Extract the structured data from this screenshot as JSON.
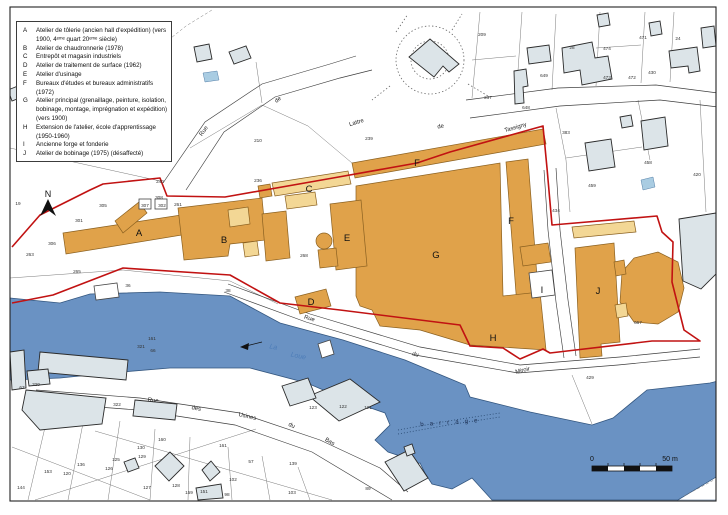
{
  "legend": {
    "items": [
      {
        "letter": "A",
        "text": "Atelier de tôlerie (ancien hall d'expédition) (vers 1900, 4ᵉᵐᵉ quart 20ᵉᵐᵉ siècle)"
      },
      {
        "letter": "B",
        "text": "Atelier de chaudronnerie (1978)"
      },
      {
        "letter": "C",
        "text": "Entrepôt et magasin industriels"
      },
      {
        "letter": "D",
        "text": "Atelier de traitement de surface (1962)"
      },
      {
        "letter": "E",
        "text": "Atelier d'usinage"
      },
      {
        "letter": "F",
        "text": "Bureaux d'études et bureaux administratifs (1972)"
      },
      {
        "letter": "G",
        "text": "Atelier principal (grenaillage, peinture, isolation, bobinage, montage, imprégnation et expédition) (vers 1900)"
      },
      {
        "letter": "H",
        "text": "Extension de l'atelier, école d'apprentissage (1950-1960)"
      },
      {
        "letter": "I",
        "text": "Ancienne forge et fonderie"
      },
      {
        "letter": "J",
        "text": "Atelier de bobinage (1975) (désaffecté)"
      }
    ]
  },
  "map": {
    "north_label": "N",
    "scale_bar": {
      "start": "0",
      "end": "50 m"
    },
    "building_labels": [
      {
        "t": "A",
        "x": 139,
        "y": 236
      },
      {
        "t": "B",
        "x": 224,
        "y": 243
      },
      {
        "t": "C",
        "x": 309,
        "y": 192
      },
      {
        "t": "D",
        "x": 311,
        "y": 305
      },
      {
        "t": "E",
        "x": 347,
        "y": 241
      },
      {
        "t": "F",
        "x": 417,
        "y": 166
      },
      {
        "t": "F",
        "x": 511,
        "y": 224
      },
      {
        "t": "G",
        "x": 436,
        "y": 258
      },
      {
        "t": "H",
        "x": 493,
        "y": 341
      },
      {
        "t": "I",
        "x": 542,
        "y": 293
      },
      {
        "t": "J",
        "x": 598,
        "y": 294
      }
    ],
    "street_labels": [
      {
        "t": "Rue",
        "x": 205,
        "y": 132,
        "r": -55
      },
      {
        "t": "de",
        "x": 279,
        "y": 101,
        "r": -38
      },
      {
        "t": "Lattre",
        "x": 357,
        "y": 124,
        "r": -17
      },
      {
        "t": "de",
        "x": 441,
        "y": 128,
        "r": -12
      },
      {
        "t": "Tassigny",
        "x": 516,
        "y": 129,
        "r": -16
      },
      {
        "t": "Rue",
        "x": 309,
        "y": 320,
        "r": 16
      },
      {
        "t": "du",
        "x": 415,
        "y": 356,
        "r": 14
      },
      {
        "t": "Miroir",
        "x": 523,
        "y": 372,
        "r": -14
      },
      {
        "t": "Rue",
        "x": 153,
        "y": 402,
        "r": 6
      },
      {
        "t": "des",
        "x": 196,
        "y": 410,
        "r": 10
      },
      {
        "t": "Usines",
        "x": 247,
        "y": 418,
        "r": 13
      },
      {
        "t": "du",
        "x": 291,
        "y": 427,
        "r": 24
      },
      {
        "t": "Bas",
        "x": 329,
        "y": 443,
        "r": 30
      }
    ],
    "river_labels": [
      {
        "t": "La",
        "x": 273,
        "y": 349,
        "r": 12
      },
      {
        "t": "Loue",
        "x": 298,
        "y": 358,
        "r": 12
      }
    ],
    "water_labels": [
      {
        "t": "barrage",
        "x": 452,
        "y": 424,
        "r": -4
      }
    ],
    "parcel_numbers": [
      {
        "t": "19",
        "x": 18,
        "y": 205
      },
      {
        "t": "240",
        "x": 160,
        "y": 183
      },
      {
        "t": "308",
        "x": 159,
        "y": 199
      },
      {
        "t": "305",
        "x": 103,
        "y": 207
      },
      {
        "t": "307",
        "x": 145,
        "y": 207
      },
      {
        "t": "302",
        "x": 162,
        "y": 207
      },
      {
        "t": "261",
        "x": 178,
        "y": 206
      },
      {
        "t": "301",
        "x": 79,
        "y": 222
      },
      {
        "t": "306",
        "x": 52,
        "y": 245
      },
      {
        "t": "263",
        "x": 30,
        "y": 256
      },
      {
        "t": "265",
        "x": 77,
        "y": 273
      },
      {
        "t": "210",
        "x": 258,
        "y": 142
      },
      {
        "t": "239",
        "x": 369,
        "y": 140
      },
      {
        "t": "236",
        "x": 258,
        "y": 182
      },
      {
        "t": "268",
        "x": 304,
        "y": 257
      },
      {
        "t": "36",
        "x": 128,
        "y": 287
      },
      {
        "t": "38",
        "x": 228,
        "y": 292
      },
      {
        "t": "209",
        "x": 482,
        "y": 36
      },
      {
        "t": "237",
        "x": 488,
        "y": 99
      },
      {
        "t": "648",
        "x": 526,
        "y": 109
      },
      {
        "t": "649",
        "x": 544,
        "y": 77
      },
      {
        "t": "28",
        "x": 572,
        "y": 49
      },
      {
        "t": "474",
        "x": 607,
        "y": 50
      },
      {
        "t": "473",
        "x": 607,
        "y": 79
      },
      {
        "t": "472",
        "x": 632,
        "y": 79
      },
      {
        "t": "471",
        "x": 643,
        "y": 39
      },
      {
        "t": "430",
        "x": 652,
        "y": 74
      },
      {
        "t": "24",
        "x": 678,
        "y": 40
      },
      {
        "t": "383",
        "x": 566,
        "y": 134
      },
      {
        "t": "458",
        "x": 648,
        "y": 164
      },
      {
        "t": "459",
        "x": 592,
        "y": 187
      },
      {
        "t": "420",
        "x": 697,
        "y": 176
      },
      {
        "t": "434",
        "x": 556,
        "y": 212
      },
      {
        "t": "667",
        "x": 638,
        "y": 324
      },
      {
        "t": "429",
        "x": 590,
        "y": 379
      },
      {
        "t": "322",
        "x": 117,
        "y": 406
      },
      {
        "t": "320",
        "x": 36,
        "y": 386
      },
      {
        "t": "67",
        "x": 22,
        "y": 389
      },
      {
        "t": "321",
        "x": 141,
        "y": 348
      },
      {
        "t": "66",
        "x": 153,
        "y": 352
      },
      {
        "t": "161",
        "x": 152,
        "y": 340
      },
      {
        "t": "160",
        "x": 162,
        "y": 441
      },
      {
        "t": "130",
        "x": 141,
        "y": 449
      },
      {
        "t": "129",
        "x": 142,
        "y": 458
      },
      {
        "t": "125",
        "x": 116,
        "y": 461
      },
      {
        "t": "126",
        "x": 109,
        "y": 470
      },
      {
        "t": "136",
        "x": 81,
        "y": 466
      },
      {
        "t": "153",
        "x": 48,
        "y": 473
      },
      {
        "t": "120",
        "x": 67,
        "y": 475
      },
      {
        "t": "144",
        "x": 21,
        "y": 489
      },
      {
        "t": "127",
        "x": 147,
        "y": 489
      },
      {
        "t": "128",
        "x": 176,
        "y": 487
      },
      {
        "t": "159",
        "x": 189,
        "y": 494
      },
      {
        "t": "151",
        "x": 204,
        "y": 493
      },
      {
        "t": "161",
        "x": 223,
        "y": 447
      },
      {
        "t": "102",
        "x": 233,
        "y": 481
      },
      {
        "t": "98",
        "x": 227,
        "y": 496
      },
      {
        "t": "89",
        "x": 368,
        "y": 490
      },
      {
        "t": "57",
        "x": 251,
        "y": 463
      },
      {
        "t": "103",
        "x": 292,
        "y": 494
      },
      {
        "t": "139",
        "x": 293,
        "y": 465
      },
      {
        "t": "123",
        "x": 313,
        "y": 409
      },
      {
        "t": "122",
        "x": 343,
        "y": 408
      },
      {
        "t": "121",
        "x": 368,
        "y": 409
      }
    ]
  },
  "colors": {
    "site_orange": "#E0A24A",
    "site_pale": "#F3D795",
    "river_blue": "#6A92C3",
    "building_gray": "#DCE4E8",
    "boundary_red": "#C11212",
    "pond_blue": "#A9CCE2"
  }
}
